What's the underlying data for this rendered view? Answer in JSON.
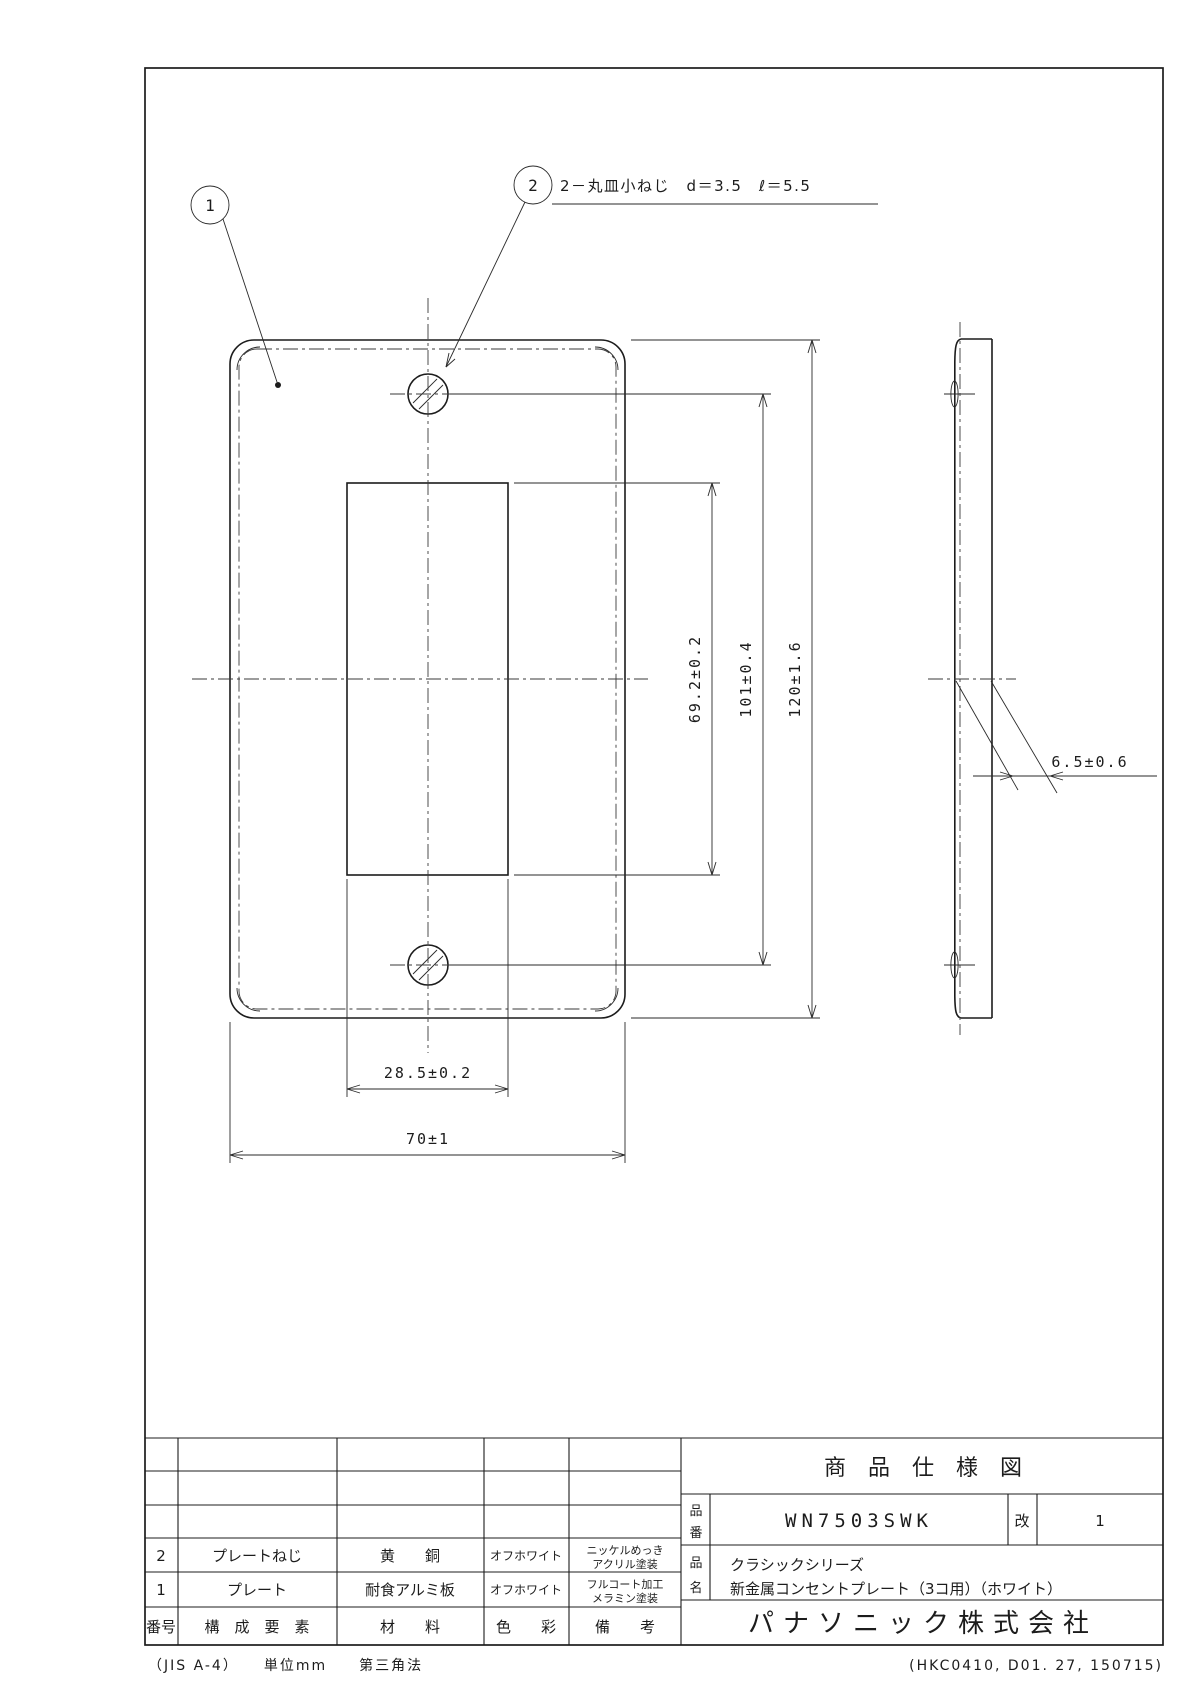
{
  "callouts": {
    "balloon_1": "1",
    "balloon_2": "2",
    "screw_note": "2－丸皿小ねじ　d＝3.5　ℓ＝5.5"
  },
  "dimensions": {
    "opening_height": "69.2±0.2",
    "screw_pitch": "101±0.4",
    "plate_height": "120±1.6",
    "opening_width": "28.5±0.2",
    "plate_width": "70±1",
    "thickness": "6.5±0.6"
  },
  "title_block": {
    "sheet_title": "商　品　仕　様　図",
    "part_no_label_top": "品",
    "part_no_label_bottom": "番",
    "part_no": "WN7503SWK",
    "rev_label": "改",
    "rev_value": "1",
    "name_label_top": "品",
    "name_label_bottom": "名",
    "product_series": "クラシックシリーズ",
    "product_name": "新金属コンセントプレート（3コ用）（ホワイト）",
    "company": "パナソニック株式会社"
  },
  "parts_table": {
    "headers": {
      "no": "番号",
      "component": "構　成　要　素",
      "material": "材　　料",
      "color": "色　　彩",
      "remarks": "備　　考"
    },
    "rows": [
      {
        "no": "2",
        "component": "プレートねじ",
        "material": "黄　　銅",
        "color": "オフホワイト",
        "remark_line1": "ニッケルめっき",
        "remark_line2": "アクリル塗装"
      },
      {
        "no": "1",
        "component": "プレート",
        "material": "耐食アルミ板",
        "color": "オフホワイト",
        "remark_line1": "フルコート加工",
        "remark_line2": "メラミン塗装"
      }
    ]
  },
  "footer": {
    "left": "（JIS A-4）　　単位mm　　第三角法",
    "right": "(HKC0410, D01. 27, 150715)"
  }
}
